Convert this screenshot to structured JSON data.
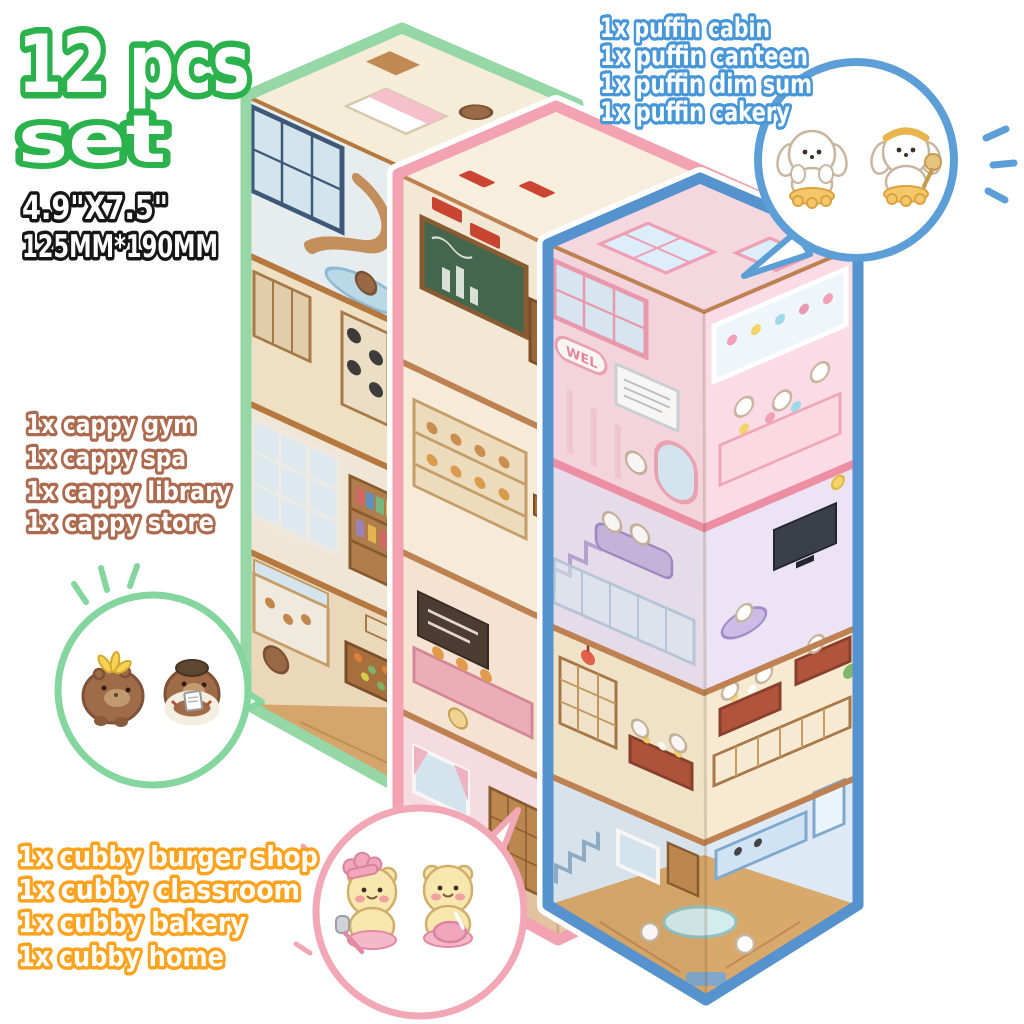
{
  "title": {
    "line1": "12 pcs",
    "line2": "set",
    "color": "#2BB24C"
  },
  "size": {
    "inches": "4.9\"X7.5\"",
    "mm": "125MM*190MM",
    "color": "#161616"
  },
  "lists": {
    "puffin": {
      "color": "#4796D8",
      "items": [
        "1x puffin cabin",
        "1x puffin canteen",
        "1x puffin dim sum",
        "1x puffin cakery"
      ]
    },
    "cappy": {
      "color": "#AC6A4E",
      "items": [
        "1x cappy gym",
        "1x cappy spa",
        "1x cappy library",
        "1x cappy store"
      ]
    },
    "cubby": {
      "color": "#FFA21D",
      "items": [
        "1x cubby burger shop",
        "1x cubby classroom",
        "1x cubby bakery",
        "1x cubby home"
      ]
    }
  },
  "sheets": {
    "cappy": {
      "label": "cappy sticker sheet",
      "border": "#96D7A6",
      "floors": [
        "attic bedroom",
        "cappy spa",
        "cappy gym",
        "cappy library",
        "cappy store"
      ]
    },
    "cubby": {
      "label": "cubby sticker sheet",
      "border": "#F2A2B0",
      "floors": [
        "cubby classroom",
        "cubby bakery",
        "cubby burger shop",
        "cubby home"
      ]
    },
    "puffin": {
      "label": "puffin sticker sheet",
      "border": "#5592CE",
      "floors": [
        "puffin cakery",
        "puffin dim sum",
        "puffin canteen",
        "puffin cabin"
      ]
    }
  },
  "signs": {
    "cakery": "WEL"
  },
  "bubbles": {
    "puffin": {
      "stroke": "#5B9FD6",
      "characters": [
        "puffin-dog-icon",
        "puffin-baker-dog-icon"
      ]
    },
    "cappy": {
      "stroke": "#85D69E",
      "characters": [
        "cappy-banana-icon",
        "cappy-swimmer-icon"
      ]
    },
    "cubby": {
      "stroke": "#F2A7B4",
      "characters": [
        "cubby-chef-bear-icon",
        "cubby-baker-bear-icon"
      ]
    }
  }
}
